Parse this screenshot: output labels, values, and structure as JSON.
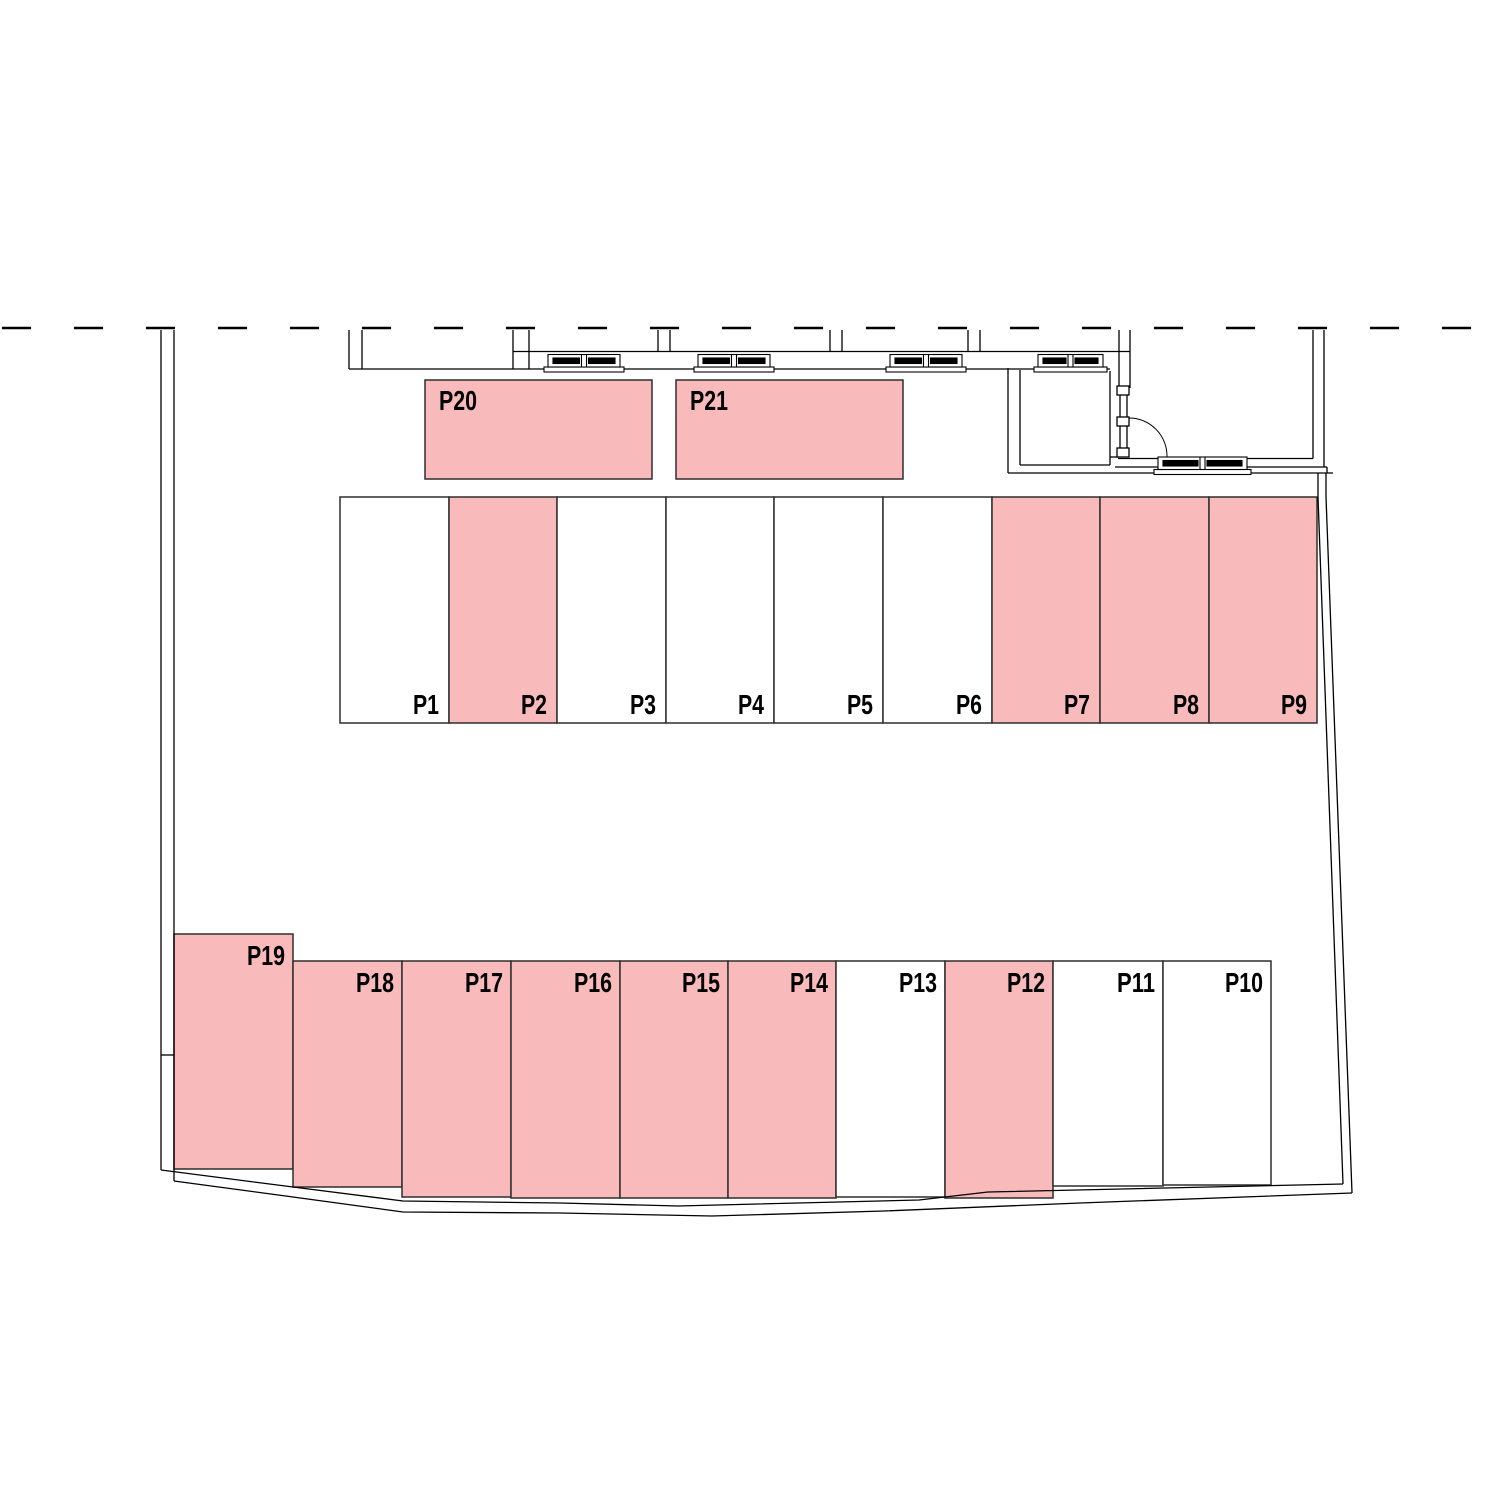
{
  "plan": {
    "highlight_color": "#f8baba",
    "stall_line_color": "#2e2e2e",
    "drawing_line_color": "#000000",
    "label_color": "#000000",
    "upper_row": {
      "y": 497,
      "bottom": 723,
      "edges": [
        340,
        449,
        557,
        666,
        774,
        883,
        992,
        1100,
        1209,
        1317
      ],
      "stalls": [
        {
          "label": "P1",
          "highlighted": false
        },
        {
          "label": "P2",
          "highlighted": true
        },
        {
          "label": "P3",
          "highlighted": false
        },
        {
          "label": "P4",
          "highlighted": false
        },
        {
          "label": "P5",
          "highlighted": false
        },
        {
          "label": "P6",
          "highlighted": false
        },
        {
          "label": "P7",
          "highlighted": true
        },
        {
          "label": "P8",
          "highlighted": true
        },
        {
          "label": "P9",
          "highlighted": true
        }
      ]
    },
    "top_boxes": [
      {
        "label": "P20",
        "x": 425,
        "y": 380,
        "w": 227,
        "h": 99,
        "highlighted": true
      },
      {
        "label": "P21",
        "x": 676,
        "y": 380,
        "w": 227,
        "h": 99,
        "highlighted": true
      }
    ],
    "lower_row": [
      {
        "label": "P19",
        "x": 174,
        "top": 934,
        "right": 293,
        "bottom": 1169,
        "highlighted": true
      },
      {
        "label": "P18",
        "x": 293,
        "top": 961,
        "right": 402,
        "bottom": 1187,
        "highlighted": true
      },
      {
        "label": "P17",
        "x": 402,
        "top": 961,
        "right": 511,
        "bottom": 1197,
        "highlighted": true
      },
      {
        "label": "P16",
        "x": 511,
        "top": 961,
        "right": 620,
        "bottom": 1198,
        "highlighted": true
      },
      {
        "label": "P15",
        "x": 620,
        "top": 961,
        "right": 728,
        "bottom": 1198,
        "highlighted": true
      },
      {
        "label": "P14",
        "x": 728,
        "top": 961,
        "right": 836,
        "bottom": 1198,
        "highlighted": true
      },
      {
        "label": "P13",
        "x": 836,
        "top": 961,
        "right": 945,
        "bottom": 1197,
        "highlighted": false
      },
      {
        "label": "P12",
        "x": 945,
        "top": 961,
        "right": 1053,
        "bottom": 1198,
        "highlighted": true
      },
      {
        "label": "P11",
        "x": 1053,
        "top": 961,
        "right": 1163,
        "bottom": 1186,
        "highlighted": false
      },
      {
        "label": "P10",
        "x": 1163,
        "top": 961,
        "right": 1271,
        "bottom": 1185,
        "highlighted": false
      }
    ]
  }
}
